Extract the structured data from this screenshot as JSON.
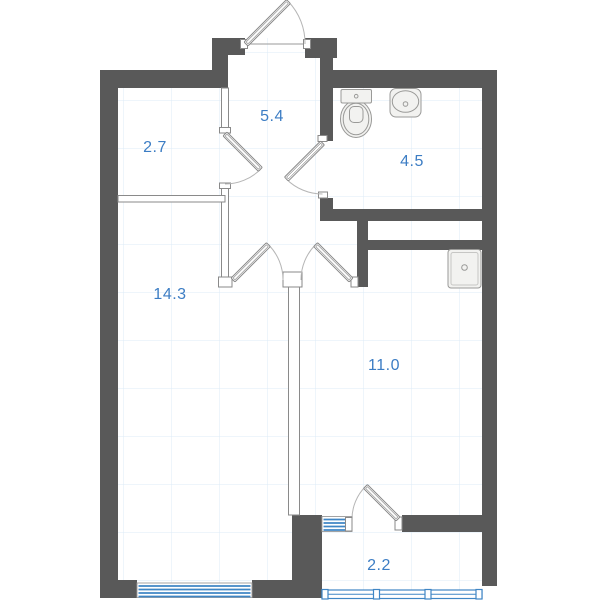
{
  "plan": {
    "rooms": [
      {
        "name": "room-top-left",
        "area": "2.7"
      },
      {
        "name": "hallway",
        "area": "5.4"
      },
      {
        "name": "bathroom",
        "area": "4.5"
      },
      {
        "name": "living-room",
        "area": "14.3"
      },
      {
        "name": "room-bottom-right",
        "area": "11.0"
      },
      {
        "name": "balcony",
        "area": "2.2"
      }
    ],
    "fixtures": [
      {
        "name": "toilet-icon"
      },
      {
        "name": "sink-icon"
      },
      {
        "name": "washing-machine-icon"
      }
    ],
    "colors": {
      "wall": "#595959",
      "partition_border": "#8a8a8a",
      "window_blue": "#3f86c5",
      "label_blue": "#3c7dc4",
      "grid": "#dcebf7",
      "fixture_fill": "#f2f2f0",
      "fixture_border": "#9a9a98",
      "arc": "#b5b5b5"
    }
  }
}
